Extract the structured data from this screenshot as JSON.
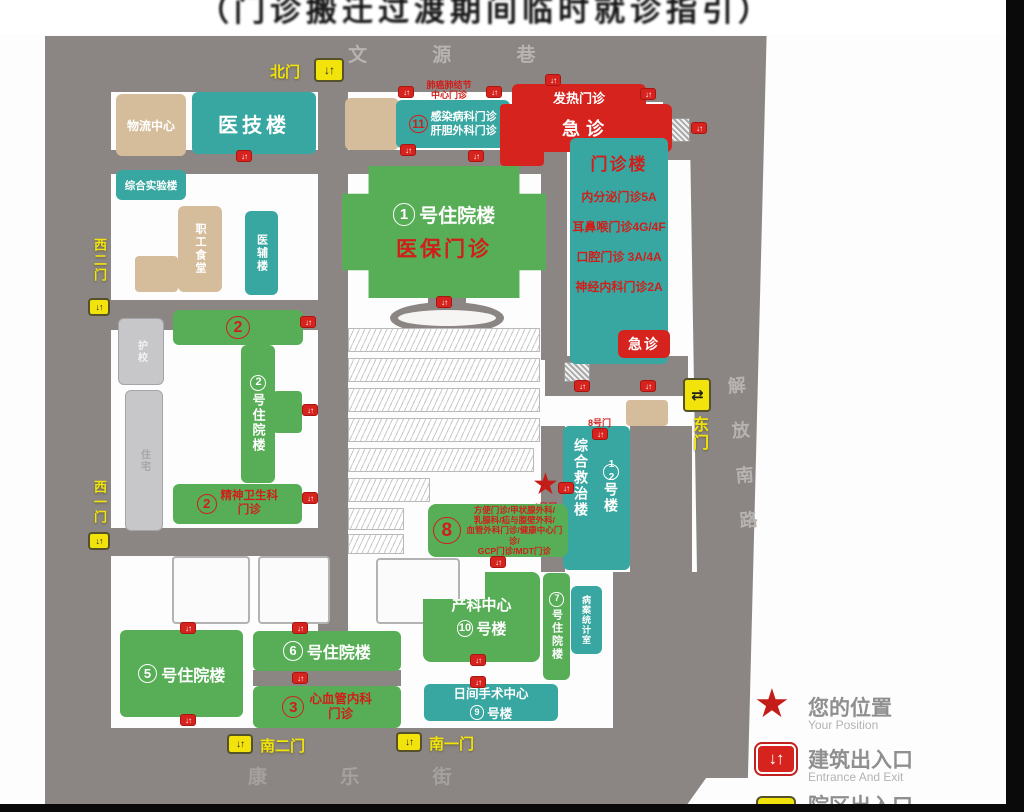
{
  "title": "（门诊搬迁过渡期间临时就诊指引）",
  "streets": {
    "north": "文 源 巷",
    "south": "康 乐 街",
    "east": "解放南路"
  },
  "gates": {
    "north": "北门",
    "west2": "西二门",
    "west1": "西一门",
    "south2": "南二门",
    "south1": "南一门",
    "east": "东门",
    "gate8": "8号门",
    "gate1": "1号门"
  },
  "icons": {
    "star": "★",
    "entrance_arrows": "↓↑"
  },
  "b": {
    "wuliu": "物流中心",
    "yiji": "医技楼",
    "lab": "综合实验楼",
    "lung": "肺癌肺结节\n中心门诊",
    "n11": "11",
    "b11": "感染病科门诊\n肝胆外科门诊",
    "fever": "发热门诊",
    "er": "急诊",
    "opd_title": "门诊楼",
    "opd1": "内分泌门诊5A",
    "opd2": "耳鼻喉门诊4G/4F",
    "opd3": "口腔门诊 3A/4A",
    "opd4": "神经内科门诊2A",
    "opd_er": "急诊",
    "n1": "1",
    "b1": "号住院楼",
    "b1_clinic": "医保门诊",
    "canteen": "职工食堂",
    "aux": "医辅楼",
    "school": "护校",
    "home": "住宅",
    "n2": "2",
    "b2": "号住院楼",
    "psych": "精神卫生科\n门诊",
    "n12": "12",
    "b12a": "综合救治楼",
    "b12b": "号楼",
    "n8": "8",
    "b8": "方便门诊/甲状腺外科/\n乳腺科/疝与腹壁外科/\n血管外科门诊/健康中心门诊/\nGCP门诊/MDT门诊",
    "chanke": "产科中心",
    "n10": "10",
    "b10": "号楼",
    "n7": "7",
    "b7": "号住院楼",
    "records": "病案统计室",
    "day": "日间手术中心",
    "n9": "9",
    "b9": "号楼",
    "n5": "5",
    "b5": "号住院楼",
    "n6": "6",
    "b6": "号住院楼",
    "n3": "3",
    "b3": "心血管内科\n门诊"
  },
  "legend": {
    "pos": "您的位置",
    "pos_en": "Your Position",
    "ent": "建筑出入口",
    "ent_en": "Entrance And Exit",
    "campus": "院区出入口"
  },
  "colors": {
    "green": "#57ae56",
    "teal": "#38a7a1",
    "tan": "#d5bd9c",
    "red": "#d7231d",
    "yellow": "#f2e30c",
    "road": "#8b8683"
  }
}
